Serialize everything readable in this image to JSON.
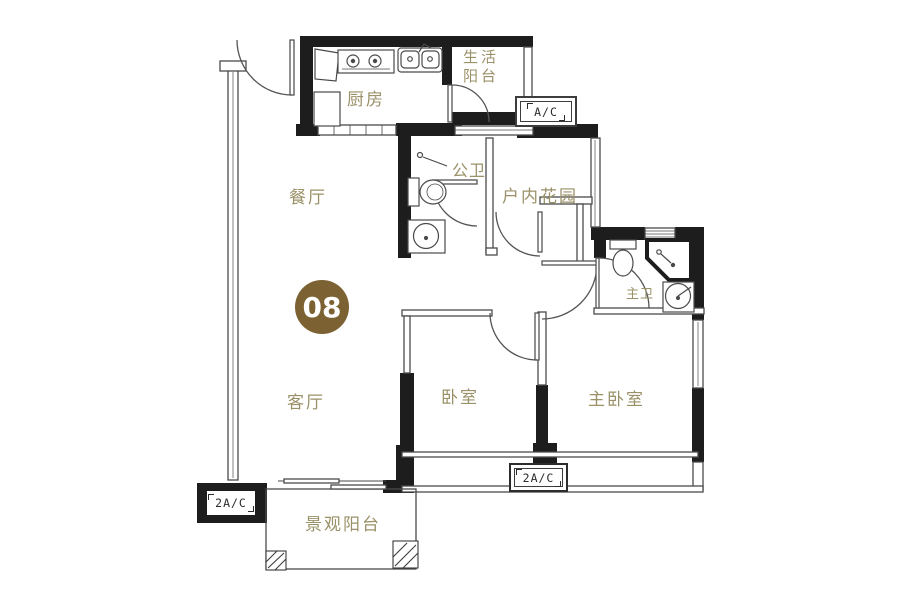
{
  "badge": {
    "number": "08"
  },
  "rooms": {
    "kitchen": "厨房",
    "life_balcony": [
      "生活",
      "阳台"
    ],
    "dining": "餐厅",
    "living": "客厅",
    "guest_bath": "公卫",
    "indoor_garden": "户内花园",
    "master_bath": "主卫",
    "bedroom": "卧室",
    "master_bedroom": "主卧室",
    "view_balcony": "景观阳台"
  },
  "ac_units": {
    "top": "A/C",
    "bottom_left": "2A/C",
    "bottom_center": "2A/C"
  },
  "icons": {
    "stove": "stove-icon",
    "kitchen_sink": "kitchen-sink-icon",
    "toilet_guest": "toilet-icon",
    "basin_guest": "wash-basin-icon",
    "toilet_master": "toilet-icon",
    "shower_master": "corner-shower-icon",
    "basin_master": "wash-basin-icon"
  },
  "colors": {
    "wall": "#1d1d1d",
    "thin_line": "#4a4a4a",
    "label": "#9a9168",
    "badge_bg": "#7c6233"
  }
}
